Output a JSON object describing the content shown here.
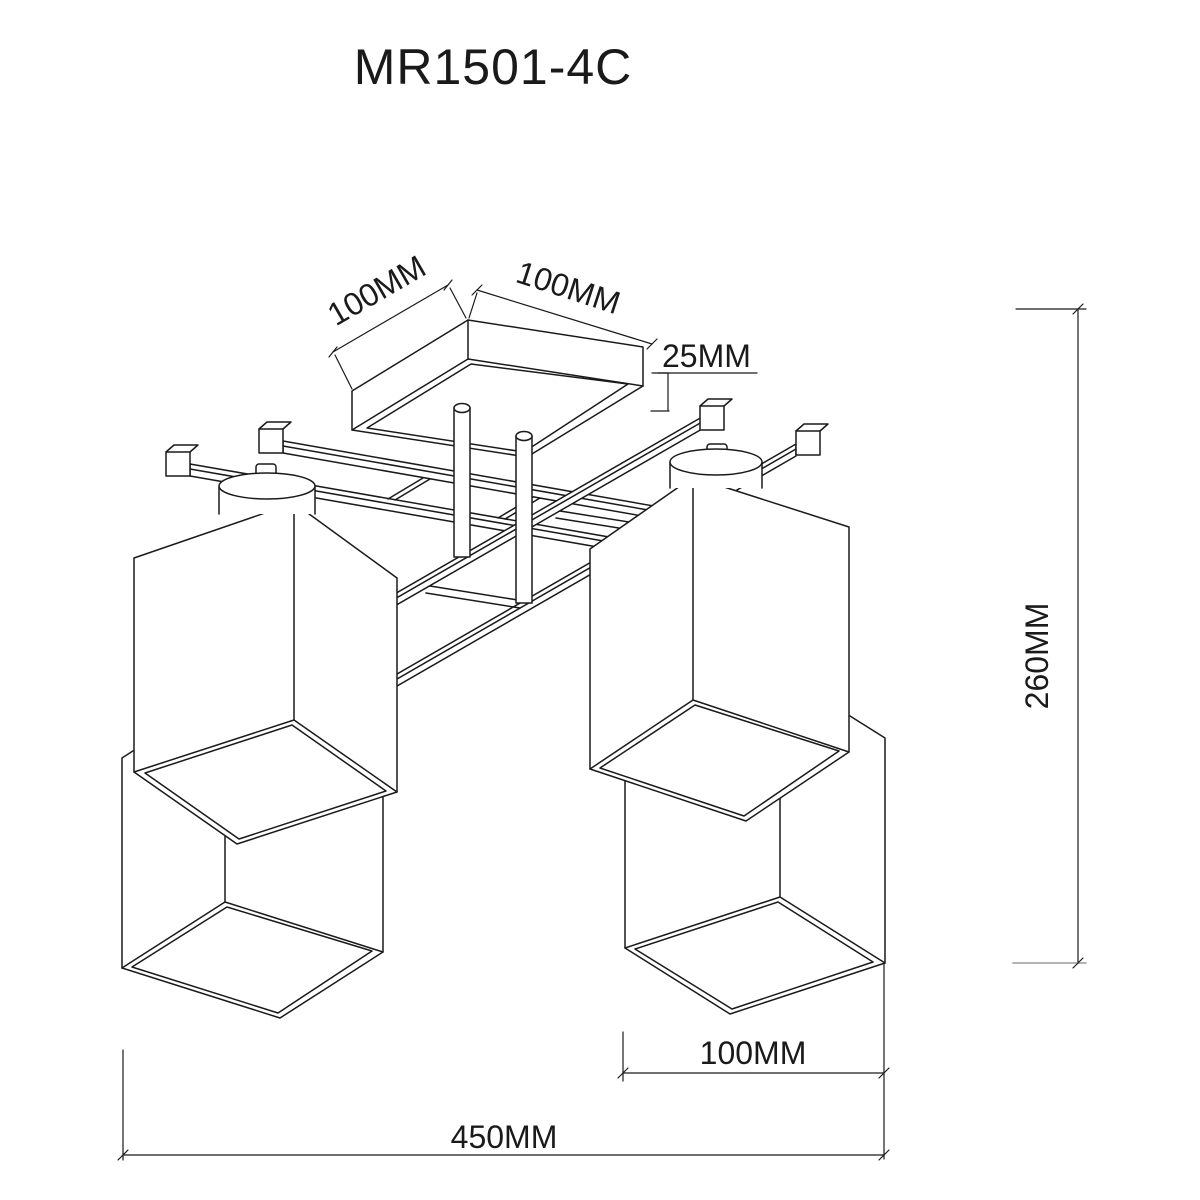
{
  "title": "MR1501-4C",
  "dimensions": {
    "canopy_side_left": "100MM",
    "canopy_side_right": "100MM",
    "canopy_height": "25MM",
    "overall_height": "260MM",
    "shade_width": "100MM",
    "overall_width": "450MM"
  },
  "colors": {
    "line": "#1a1a1a",
    "dim_faint": "#9a9a9a",
    "background": "#ffffff"
  }
}
